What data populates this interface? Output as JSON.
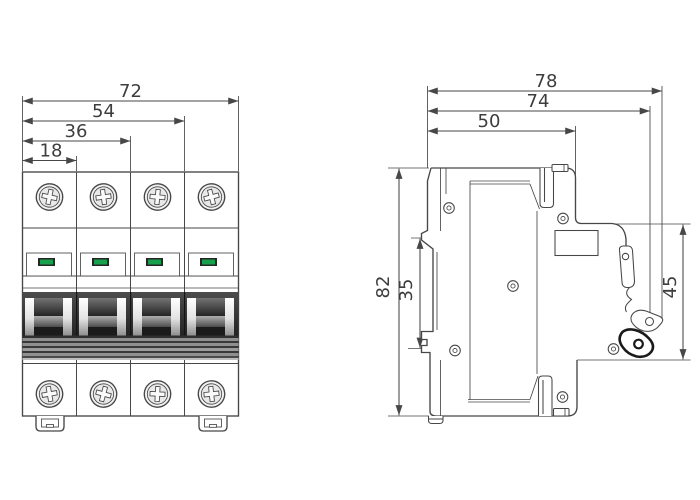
{
  "front_view": {
    "pole_count": 4,
    "width_dims": [
      {
        "id": "overall-width",
        "label": "72"
      },
      {
        "id": "three-pole-width",
        "label": "54"
      },
      {
        "id": "two-pole-width",
        "label": "36"
      },
      {
        "id": "one-pole-width",
        "label": "18"
      }
    ]
  },
  "side_view": {
    "width_dims": [
      {
        "id": "overall-depth",
        "label": "78"
      },
      {
        "id": "depth-to-handle",
        "label": "74"
      },
      {
        "id": "body-depth",
        "label": "50"
      }
    ],
    "height_dims": [
      {
        "id": "overall-height",
        "label": "82"
      },
      {
        "id": "din-slot-height",
        "label": "35"
      },
      {
        "id": "front-face-height",
        "label": "45"
      }
    ]
  },
  "colors": {
    "line": "#474747",
    "text": "#3d3d3d",
    "indicator_green": "#18a04c",
    "indicator_frame": "#262626"
  }
}
